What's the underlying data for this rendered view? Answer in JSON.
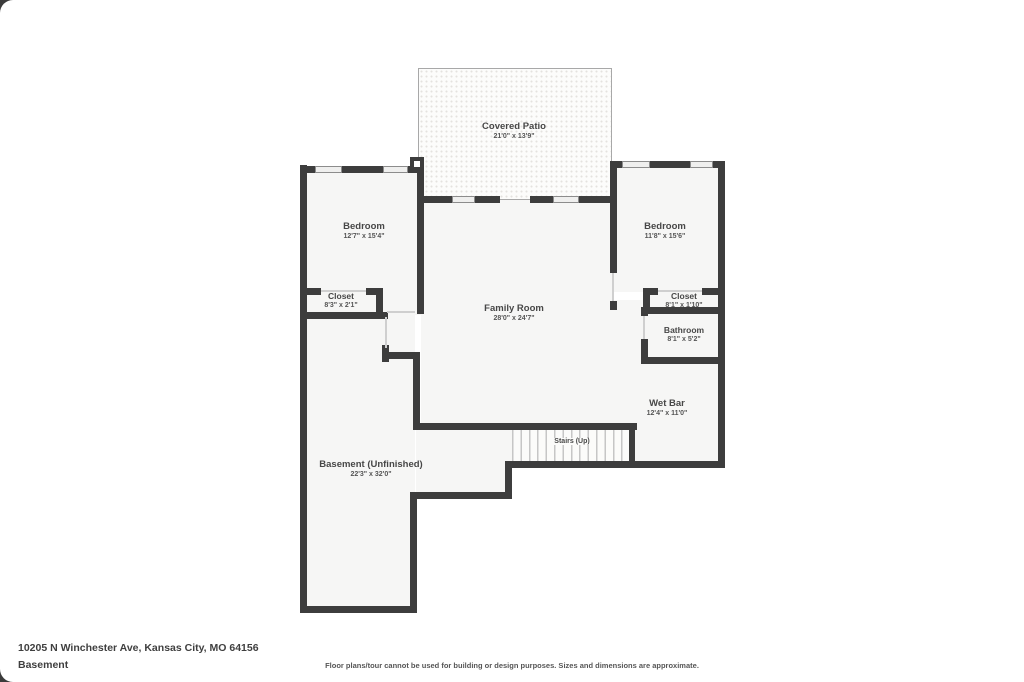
{
  "floorplan": {
    "rooms": {
      "covered_patio": {
        "name": "Covered Patio",
        "dims": "21'0\" x 13'9\""
      },
      "bedroom_left": {
        "name": "Bedroom",
        "dims": "12'7\" x 15'4\""
      },
      "closet_left": {
        "name": "Closet",
        "dims": "8'3\" x 2'1\""
      },
      "family_room": {
        "name": "Family Room",
        "dims": "28'0\" x 24'7\""
      },
      "bedroom_right": {
        "name": "Bedroom",
        "dims": "11'8\" x 15'6\""
      },
      "closet_right": {
        "name": "Closet",
        "dims": "8'1\" x 1'10\""
      },
      "bathroom": {
        "name": "Bathroom",
        "dims": "8'1\" x 5'2\""
      },
      "wet_bar": {
        "name": "Wet Bar",
        "dims": "12'4\" x 11'0\""
      },
      "stairs": {
        "name": "Stairs (Up)"
      },
      "basement": {
        "name": "Basement (Unfinished)",
        "dims": "22'3\" x 32'0\""
      }
    },
    "colors": {
      "wall": "#3d3d3d",
      "room_fill": "#f6f6f5",
      "text": "#474747"
    },
    "footer": {
      "address": "10205 N Winchester Ave, Kansas City, MO 64156",
      "level": "Basement",
      "disclaimer": "Floor plans/tour cannot be used for building or design purposes. Sizes and dimensions are approximate."
    }
  }
}
